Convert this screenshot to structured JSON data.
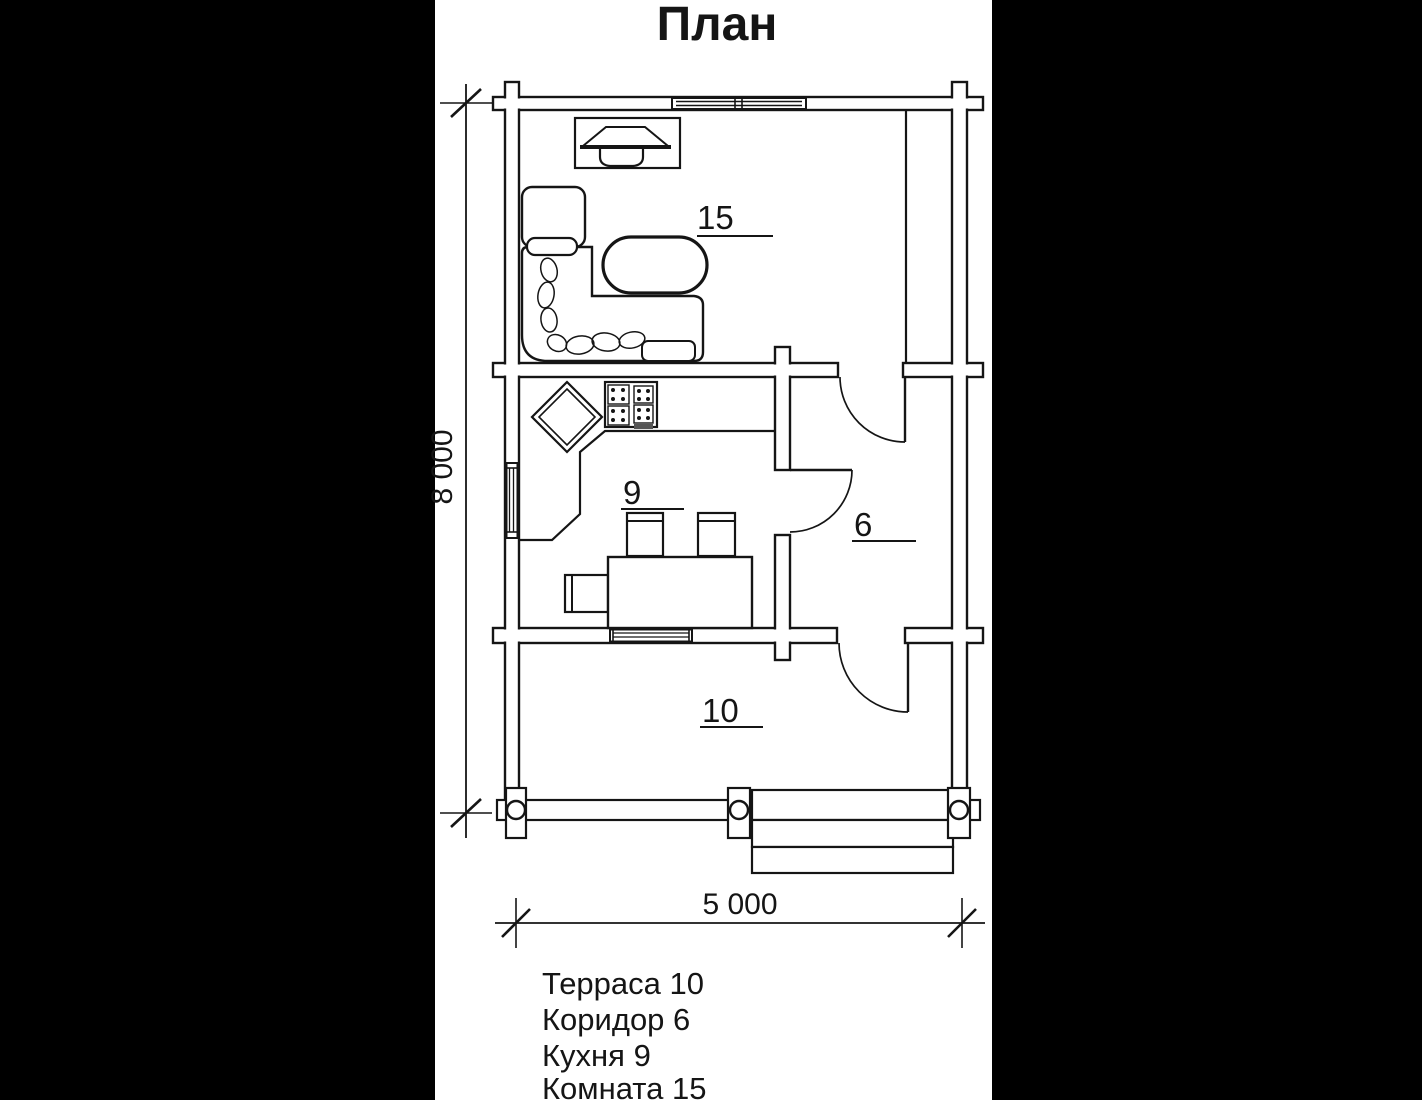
{
  "title": "План",
  "dimensions": {
    "width_label": "5 000",
    "height_label": "8 000"
  },
  "rooms": [
    {
      "number": "15",
      "name": "Комната"
    },
    {
      "number": "9",
      "name": "Кухня"
    },
    {
      "number": "6",
      "name": "Коридор"
    },
    {
      "number": "10",
      "name": "Терраса"
    }
  ],
  "legend": {
    "items": [
      "Терраса 10",
      "Коридор 6",
      "Кухня 9",
      "Комната 15"
    ]
  },
  "colors": {
    "background": "#000000",
    "paper": "#ffffff",
    "ink": "#151515"
  }
}
